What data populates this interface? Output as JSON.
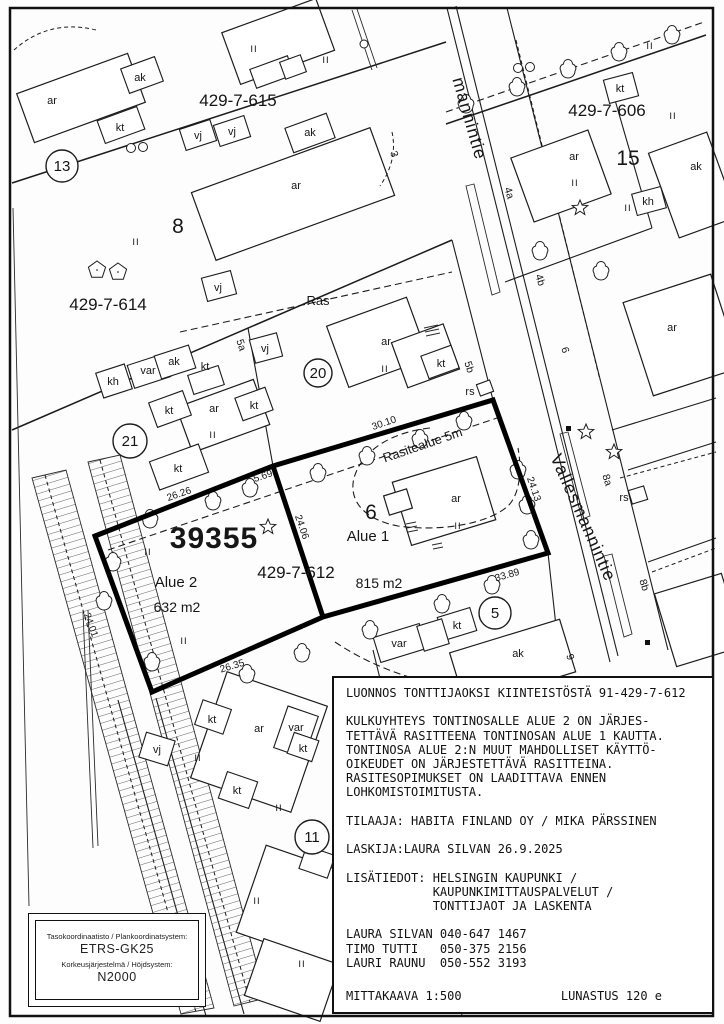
{
  "map": {
    "parcel_615": "429-7-615",
    "parcel_614": "429-7-614",
    "parcel_606": "429-7-606",
    "parcel_612": "429-7-612",
    "new_plot": "39355",
    "plot_8": "8",
    "plot_15": "15",
    "plot_6": "6",
    "circle_13": "13",
    "circle_21": "21",
    "circle_20": "20",
    "circle_5": "5",
    "circle_11": "11",
    "alue1": "Alue 1",
    "alue1_area": "815 m2",
    "alue2": "Alue 2",
    "alue2_area": "632 m2",
    "easement": "Rasitealue 5m",
    "ras": "Ras",
    "street": "Vallesmannintie",
    "street_partial": "mannintie",
    "dim_2626": "26.26",
    "dim_569": "5.69",
    "dim_3010": "30.10",
    "dim_2406": "24.06",
    "dim_2413": "24.13",
    "dim_3389": "33.89",
    "dim_2635": "26.35",
    "dim_2401": "24.01",
    "addr_3": "3",
    "addr_4a": "4a",
    "addr_4b": "4b",
    "addr_5a": "5a",
    "addr_5b": "5b",
    "addr_6": "6",
    "addr_8a": "8a",
    "addr_8b": "8b",
    "addr_9": "9",
    "code_ar": "ar",
    "code_ak": "ak",
    "code_kt": "kt",
    "code_kh": "kh",
    "code_var": "var",
    "code_vj": "vj",
    "code_rs": "rs",
    "floors_II": "II"
  },
  "notes": {
    "text": "LUONNOS TONTTIJAOKSI KIINTEISTÖSTÄ 91-429-7-612\n\nKULKUYHTEYS TONTINOSALLE ALUE 2 ON JÄRJES-\nTETTÄVÄ RASITTEENA TONTINOSAN ALUE 1 KAUTTA.\nTONTINOSA ALUE 2:N MUUT MAHDOLLISET KÄYTTÖ-\nOIKEUDET ON JÄRJESTETTÄVÄ RASITTEINA.\nRASITESOPIMUKSET ON LAADITTAVA ENNEN\nLOHKOMISTOIMITUSTA.\n\nTILAAJA: HABITA FINLAND OY / MIKA PÄRSSINEN\n\nLASKIJA:LAURA SILVAN 26.9.2025\n\nLISÄTIEDOT: HELSINGIN KAUPUNKI /\n            KAUPUNKIMITTAUSPALVELUT /\n            TONTTIJAOT JA LASKENTA\n\nLAURA SILVAN 040-647 1467\nTIMO TUTTI   050-375 2156\nLAURI RAUNU  050-552 3193",
    "scale": "MITTAKAAVA 1:500",
    "redemption": "LUNASTUS 120 e"
  },
  "coord_box": {
    "plane_label": "Tasokoordinaatisto / Plankoordinatsystem:",
    "plane_value": "ETRS-GK25",
    "height_label": "Korkeusjärjestelmä / Höjdsystem:",
    "height_value": "N2000"
  }
}
